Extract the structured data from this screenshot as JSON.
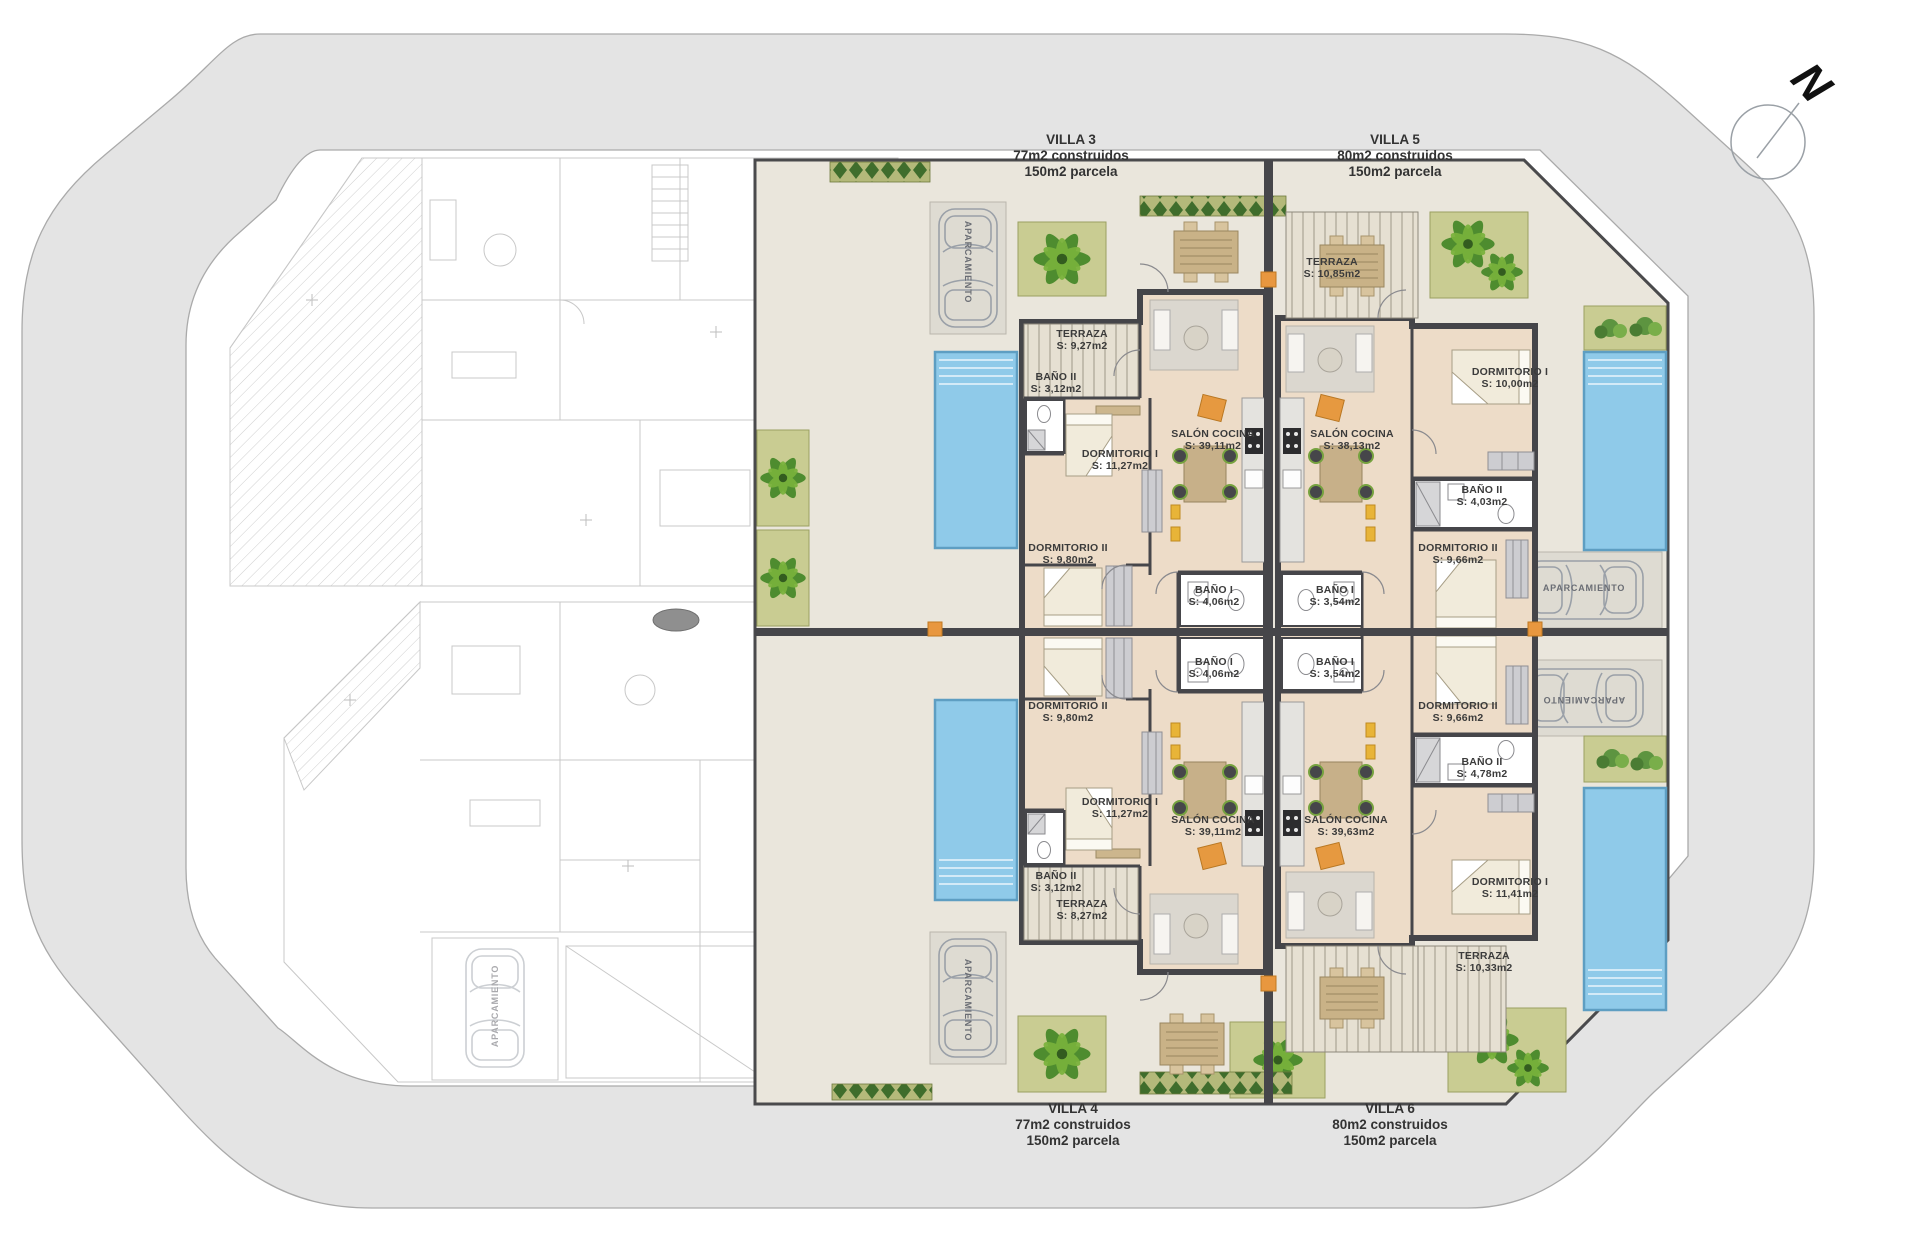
{
  "compass": {
    "north_label": "N"
  },
  "parking_label": "APARCAMIENTO",
  "villas": [
    {
      "id": "villa-3",
      "title": "VILLA 3",
      "line1": "77m2 construidos",
      "line2": "150m2 parcela",
      "rooms": [
        {
          "name": "TERRAZA",
          "area": "S: 9,27m2"
        },
        {
          "name": "BAÑO II",
          "area": "S: 3,12m2"
        },
        {
          "name": "DORMITORIO I",
          "area": "S: 11,27m2"
        },
        {
          "name": "SALÓN COCINA",
          "area": "S: 39,11m2"
        },
        {
          "name": "DORMITORIO II",
          "area": "S: 9,80m2"
        },
        {
          "name": "BAÑO I",
          "area": "S: 4,06m2"
        }
      ]
    },
    {
      "id": "villa-5",
      "title": "VILLA 5",
      "line1": "80m2 construidos",
      "line2": "150m2 parcela",
      "rooms": [
        {
          "name": "TERRAZA",
          "area": "S: 10,85m2"
        },
        {
          "name": "DORMITORIO I",
          "area": "S: 10,00m2"
        },
        {
          "name": "BAÑO II",
          "area": "S: 4,03m2"
        },
        {
          "name": "SALÓN COCINA",
          "area": "S: 38,13m2"
        },
        {
          "name": "DORMITORIO II",
          "area": "S: 9,66m2"
        },
        {
          "name": "BAÑO I",
          "area": "S: 3,54m2"
        }
      ]
    },
    {
      "id": "villa-4",
      "title": "VILLA 4",
      "line1": "77m2 construidos",
      "line2": "150m2 parcela",
      "rooms": [
        {
          "name": "DORMITORIO II",
          "area": "S: 9,80m2"
        },
        {
          "name": "BAÑO I",
          "area": "S: 4,06m2"
        },
        {
          "name": "DORMITORIO I",
          "area": "S: 11,27m2"
        },
        {
          "name": "SALÓN COCINA",
          "area": "S: 39,11m2"
        },
        {
          "name": "BAÑO II",
          "area": "S: 3,12m2"
        },
        {
          "name": "TERRAZA",
          "area": "S: 8,27m2"
        }
      ]
    },
    {
      "id": "villa-6",
      "title": "VILLA 6",
      "line1": "80m2 construidos",
      "line2": "150m2 parcela",
      "rooms": [
        {
          "name": "BAÑO I",
          "area": "S: 3,54m2"
        },
        {
          "name": "DORMITORIO II",
          "area": "S: 9,66m2"
        },
        {
          "name": "BAÑO II",
          "area": "S: 4,78m2"
        },
        {
          "name": "SALÓN COCINA",
          "area": "S: 39,63m2"
        },
        {
          "name": "DORMITORIO I",
          "area": "S: 11,41m2"
        },
        {
          "name": "TERRAZA",
          "area": "S: 10,33m2"
        }
      ]
    }
  ]
}
